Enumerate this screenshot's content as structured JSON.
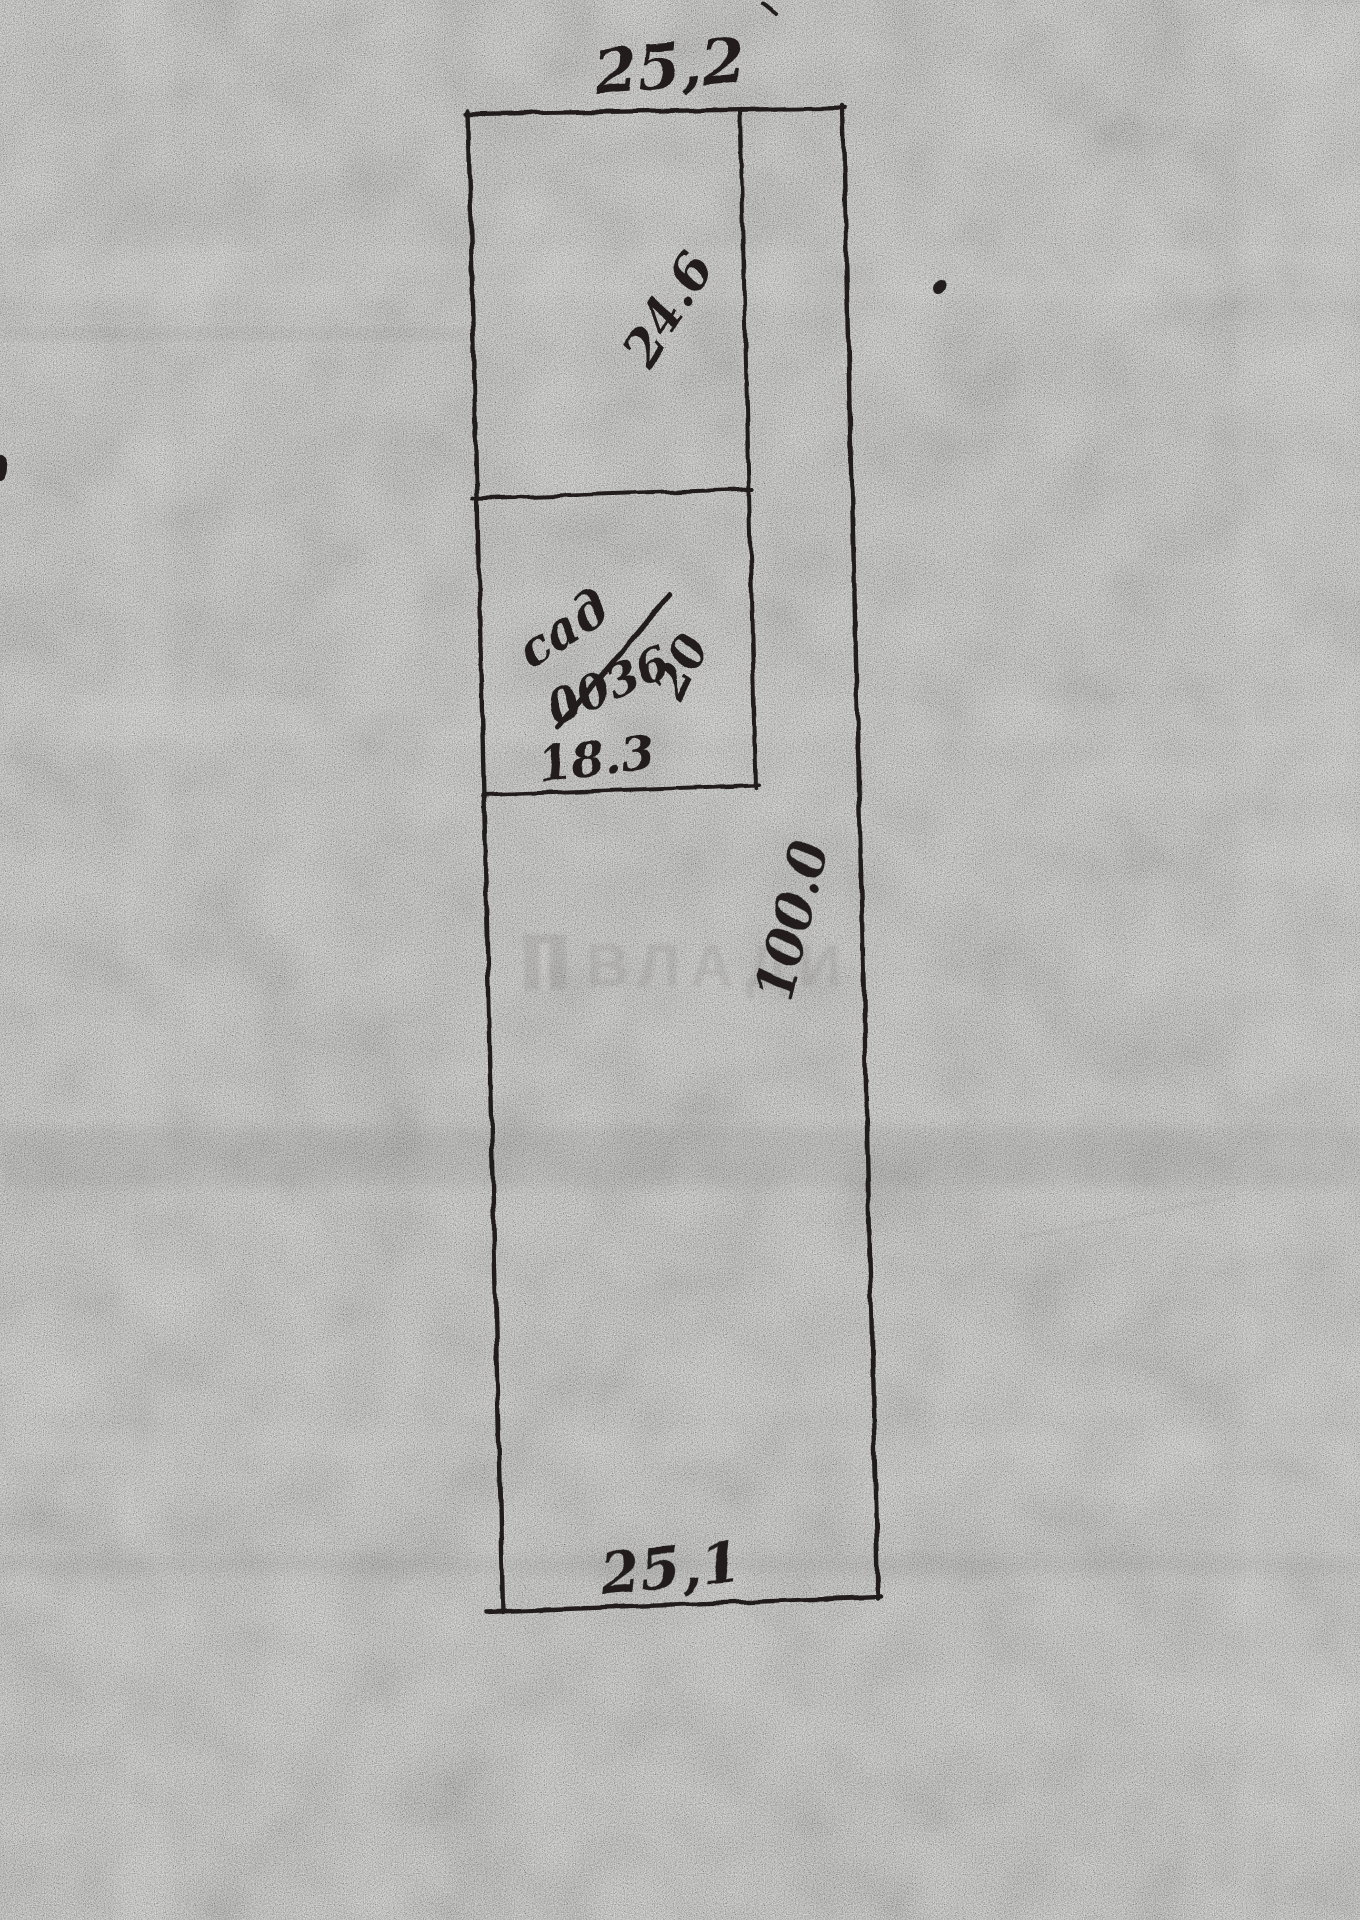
{
  "sketch": {
    "paper_color": "#b3b2b0",
    "ink_color": "#201f1d",
    "labels": {
      "top_width": "25,2",
      "upper_depth": "24.6",
      "garden_word": "сад",
      "garden_number": "0036",
      "small_side": "20",
      "inner_width": "18.3",
      "total_length": "100.0",
      "bottom_width": "25,1"
    },
    "watermark": "ВЛАДИ"
  }
}
